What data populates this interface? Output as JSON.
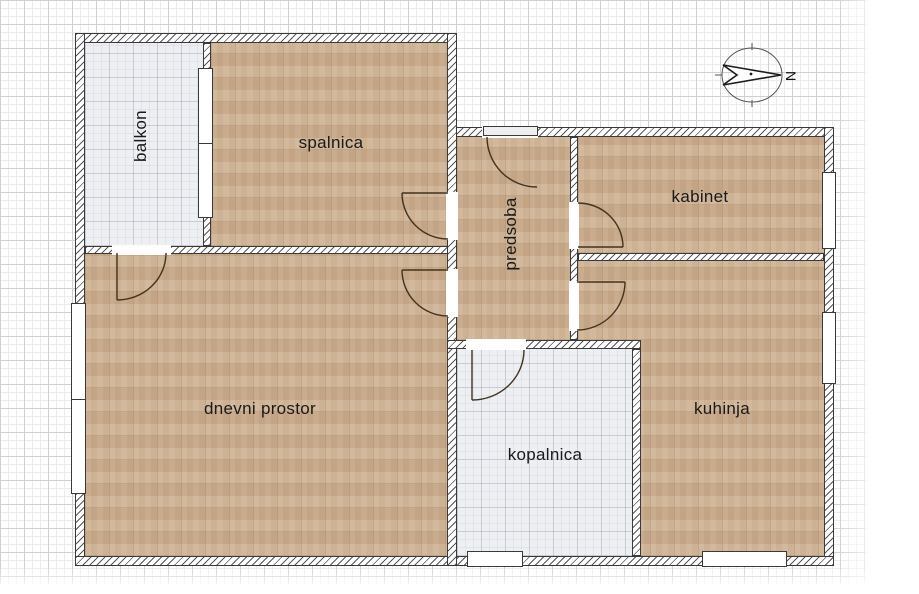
{
  "title": "Apartment floor plan",
  "rooms": [
    {
      "label": "balkon",
      "floor": "tile",
      "text_orientation": "vertical"
    },
    {
      "label": "spalnica",
      "floor": "parquet",
      "text_orientation": "horizontal"
    },
    {
      "label": "predsoba",
      "floor": "parquet",
      "text_orientation": "vertical"
    },
    {
      "label": "kabinet",
      "floor": "parquet",
      "text_orientation": "horizontal"
    },
    {
      "label": "dnevni prostor",
      "floor": "parquet",
      "text_orientation": "horizontal"
    },
    {
      "label": "kopalnica",
      "floor": "tile",
      "text_orientation": "horizontal"
    },
    {
      "label": "kuhinja",
      "floor": "parquet",
      "text_orientation": "horizontal"
    }
  ],
  "compass": {
    "letter": "N",
    "direction": "north"
  },
  "colors": {
    "parquet": "#ccae8e",
    "tile": "#edeff2",
    "wall_line": "#3a3a3a",
    "grid_major": "#cfd0d5",
    "grid_minor": "#ebecee",
    "door_arc": "#42331f",
    "label_text": "#191919"
  }
}
